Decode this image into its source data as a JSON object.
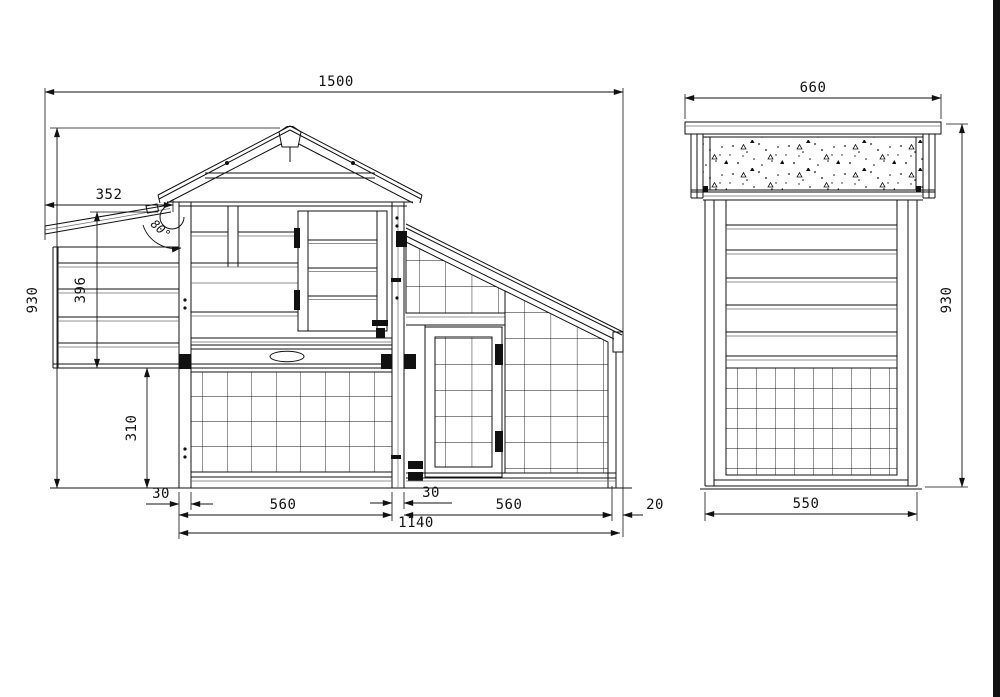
{
  "drawing": {
    "type": "technical-orthographic-drawing",
    "subject": "chicken coop / hutch, front elevation and side elevation",
    "line_color": "#111111",
    "background": "#ffffff",
    "front_view": {
      "dim_overall_width": "1500",
      "dim_nest_lid_width": "352",
      "dim_nest_box_height": "396",
      "dim_overall_height": "930",
      "dim_ground_clearance": "310",
      "dim_left_leg_width": "30",
      "dim_left_bay_width": "560",
      "dim_center_post_width": "30",
      "dim_right_bay_width": "560",
      "dim_end_overhang": "20",
      "dim_base_width": "1140",
      "dim_lid_open_angle": "80°"
    },
    "side_view": {
      "dim_roof_depth": "660",
      "dim_body_depth": "550",
      "dim_overall_height": "930"
    }
  }
}
